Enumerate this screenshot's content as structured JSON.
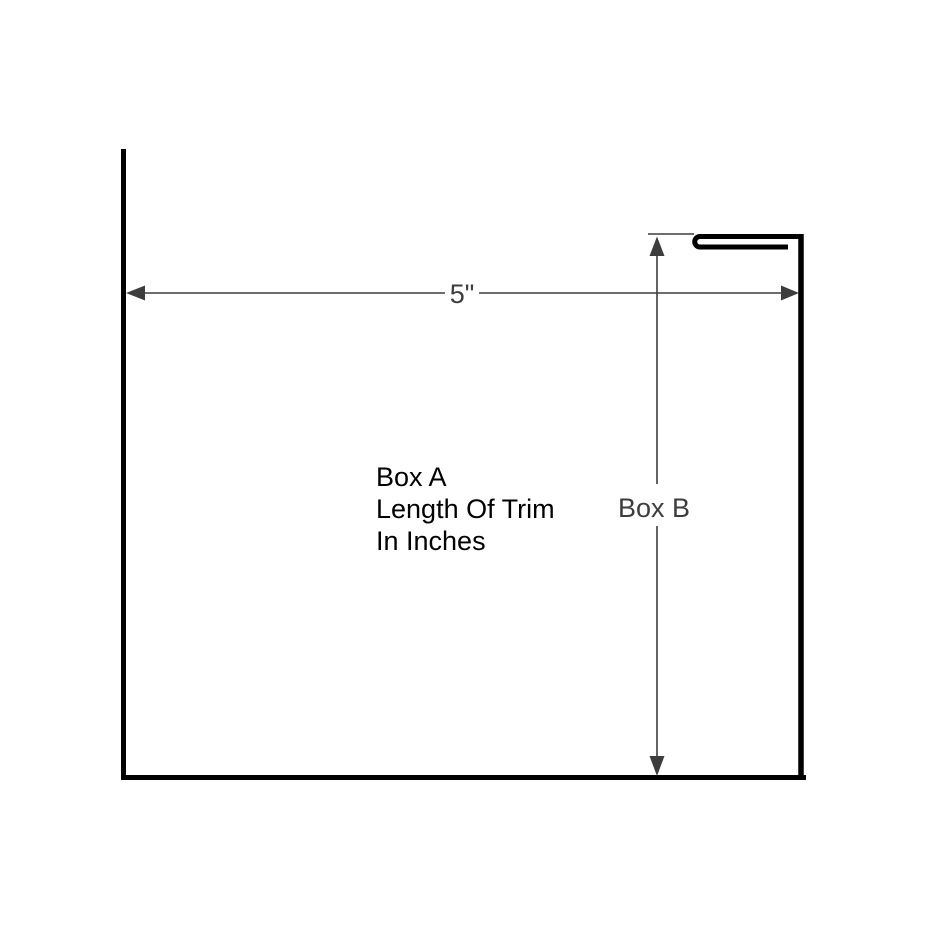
{
  "figure": {
    "kind": "trim-profile-dimension-diagram",
    "background": "#ffffff"
  },
  "dimensions": {
    "width_label": "5\"",
    "height_label": "Box B"
  },
  "annotation": {
    "lines": [
      "Box A",
      "Length Of Trim",
      "In Inches"
    ]
  },
  "colors": {
    "outline": "#000000",
    "dimension": "#3d3d3d",
    "annotation_text": "#000000"
  }
}
